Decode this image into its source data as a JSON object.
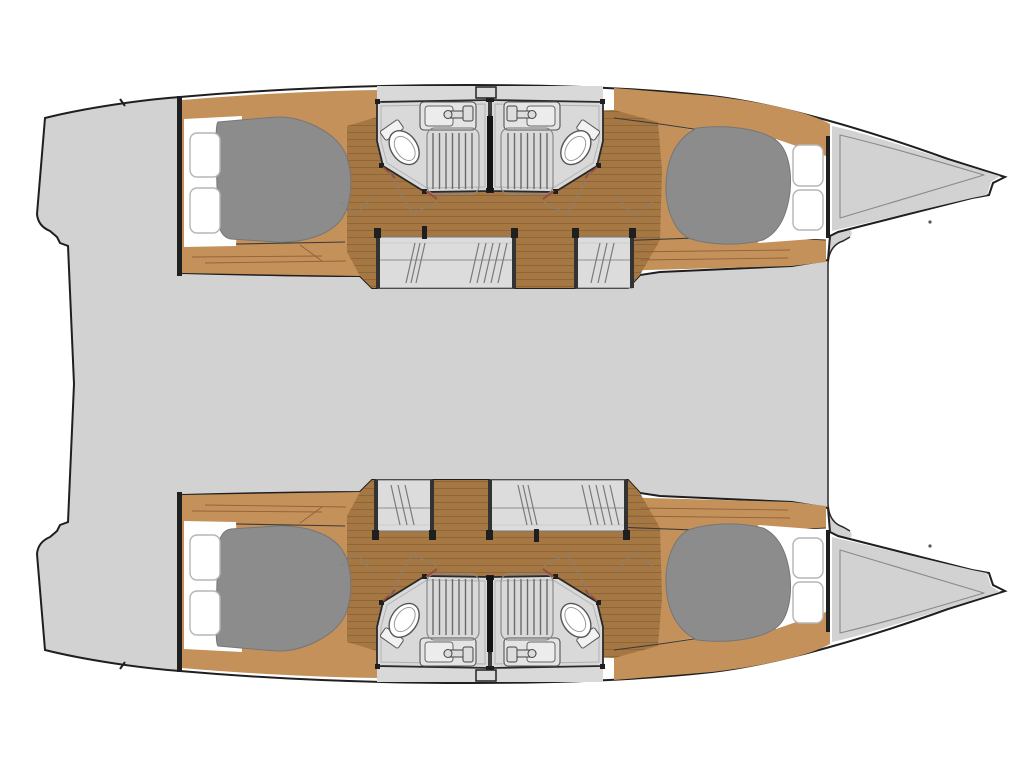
{
  "title": "Catamaran yacht interior layout plan — top-down view, bow to the right, 4 double cabins and 4 bathrooms",
  "colors": {
    "background": "#ffffff",
    "deck": "#d2d2d2",
    "hull_outline": "#1f1f1f",
    "cabin_white": "#ffffff",
    "wood_light": "#c5915a",
    "wood_dark": "#a57743",
    "plank_line": "#8f6339",
    "bed": "#8c8c8c",
    "bathroom_floor": "#d9d9d9",
    "steps": "#dcdcdc",
    "divider": "#151515",
    "door_accent": "#9c4a3a"
  },
  "vessel": {
    "type": "sailing catamaran floor plan",
    "orientation": "bow to the right, stern to the left",
    "symmetry": "port (top) and starboard (bottom) hulls mirrored about the centerline",
    "bridge_deck": "undetailed light-gray saloon / cockpit deck between the hulls",
    "bow_area": "two pointed bow decks with inner liner outline and anchor fitting notch",
    "stern_area": "two gray swim platforms with boarding step at the transoms"
  },
  "hulls": [
    {
      "name": "port hull (top)",
      "cabins": [
        {
          "position": "aft",
          "berth": "double berth (gray mattress)",
          "deck_hatches": 2,
          "floor": "teak planking with light trim"
        },
        {
          "position": "forward",
          "berth": "double berth (gray mattress)",
          "deck_hatches": 2,
          "floor": "teak planking with light trim"
        }
      ],
      "bathrooms": [
        {
          "position": "amidships aft-facing",
          "fixtures": [
            "toilet",
            "sink with faucet",
            "shower with slatted grate"
          ],
          "door": "angled door with dashed swing arc"
        },
        {
          "position": "amidships forward-facing",
          "fixtures": [
            "toilet",
            "sink with faucet",
            "shower with slatted grate"
          ],
          "door": "angled door with dashed swing arc"
        }
      ],
      "companionways": [
        {
          "position": "aft of amidships",
          "width": "wide",
          "marks": "diagonal tread hatching"
        },
        {
          "position": "forward of amidships",
          "width": "narrow",
          "marks": "diagonal tread hatching"
        }
      ]
    },
    {
      "name": "starboard hull (bottom)",
      "cabins": [
        {
          "position": "aft",
          "berth": "double berth (gray mattress)",
          "deck_hatches": 2,
          "floor": "teak planking with light trim"
        },
        {
          "position": "forward",
          "berth": "double berth (gray mattress)",
          "deck_hatches": 2,
          "floor": "teak planking with light trim"
        }
      ],
      "bathrooms": [
        {
          "position": "amidships aft-facing",
          "fixtures": [
            "toilet",
            "sink with faucet",
            "shower with slatted grate"
          ],
          "door": "angled door with dashed swing arc"
        },
        {
          "position": "amidships forward-facing",
          "fixtures": [
            "toilet",
            "sink with faucet",
            "shower with slatted grate"
          ],
          "door": "angled door with dashed swing arc"
        }
      ],
      "companionways": [
        {
          "position": "aft of amidships",
          "width": "narrow",
          "marks": "diagonal tread hatching"
        },
        {
          "position": "forward of amidships",
          "width": "wide",
          "marks": "diagonal tread hatching"
        }
      ]
    }
  ],
  "counts": {
    "hulls": 2,
    "double_cabins": 4,
    "berths": 4,
    "bathrooms": 4,
    "toilets": 4,
    "sinks": 4,
    "showers": 4,
    "deck_hatches": 8,
    "companionway_steps": 4,
    "swim_platforms": 2,
    "bow_decks": 2
  }
}
